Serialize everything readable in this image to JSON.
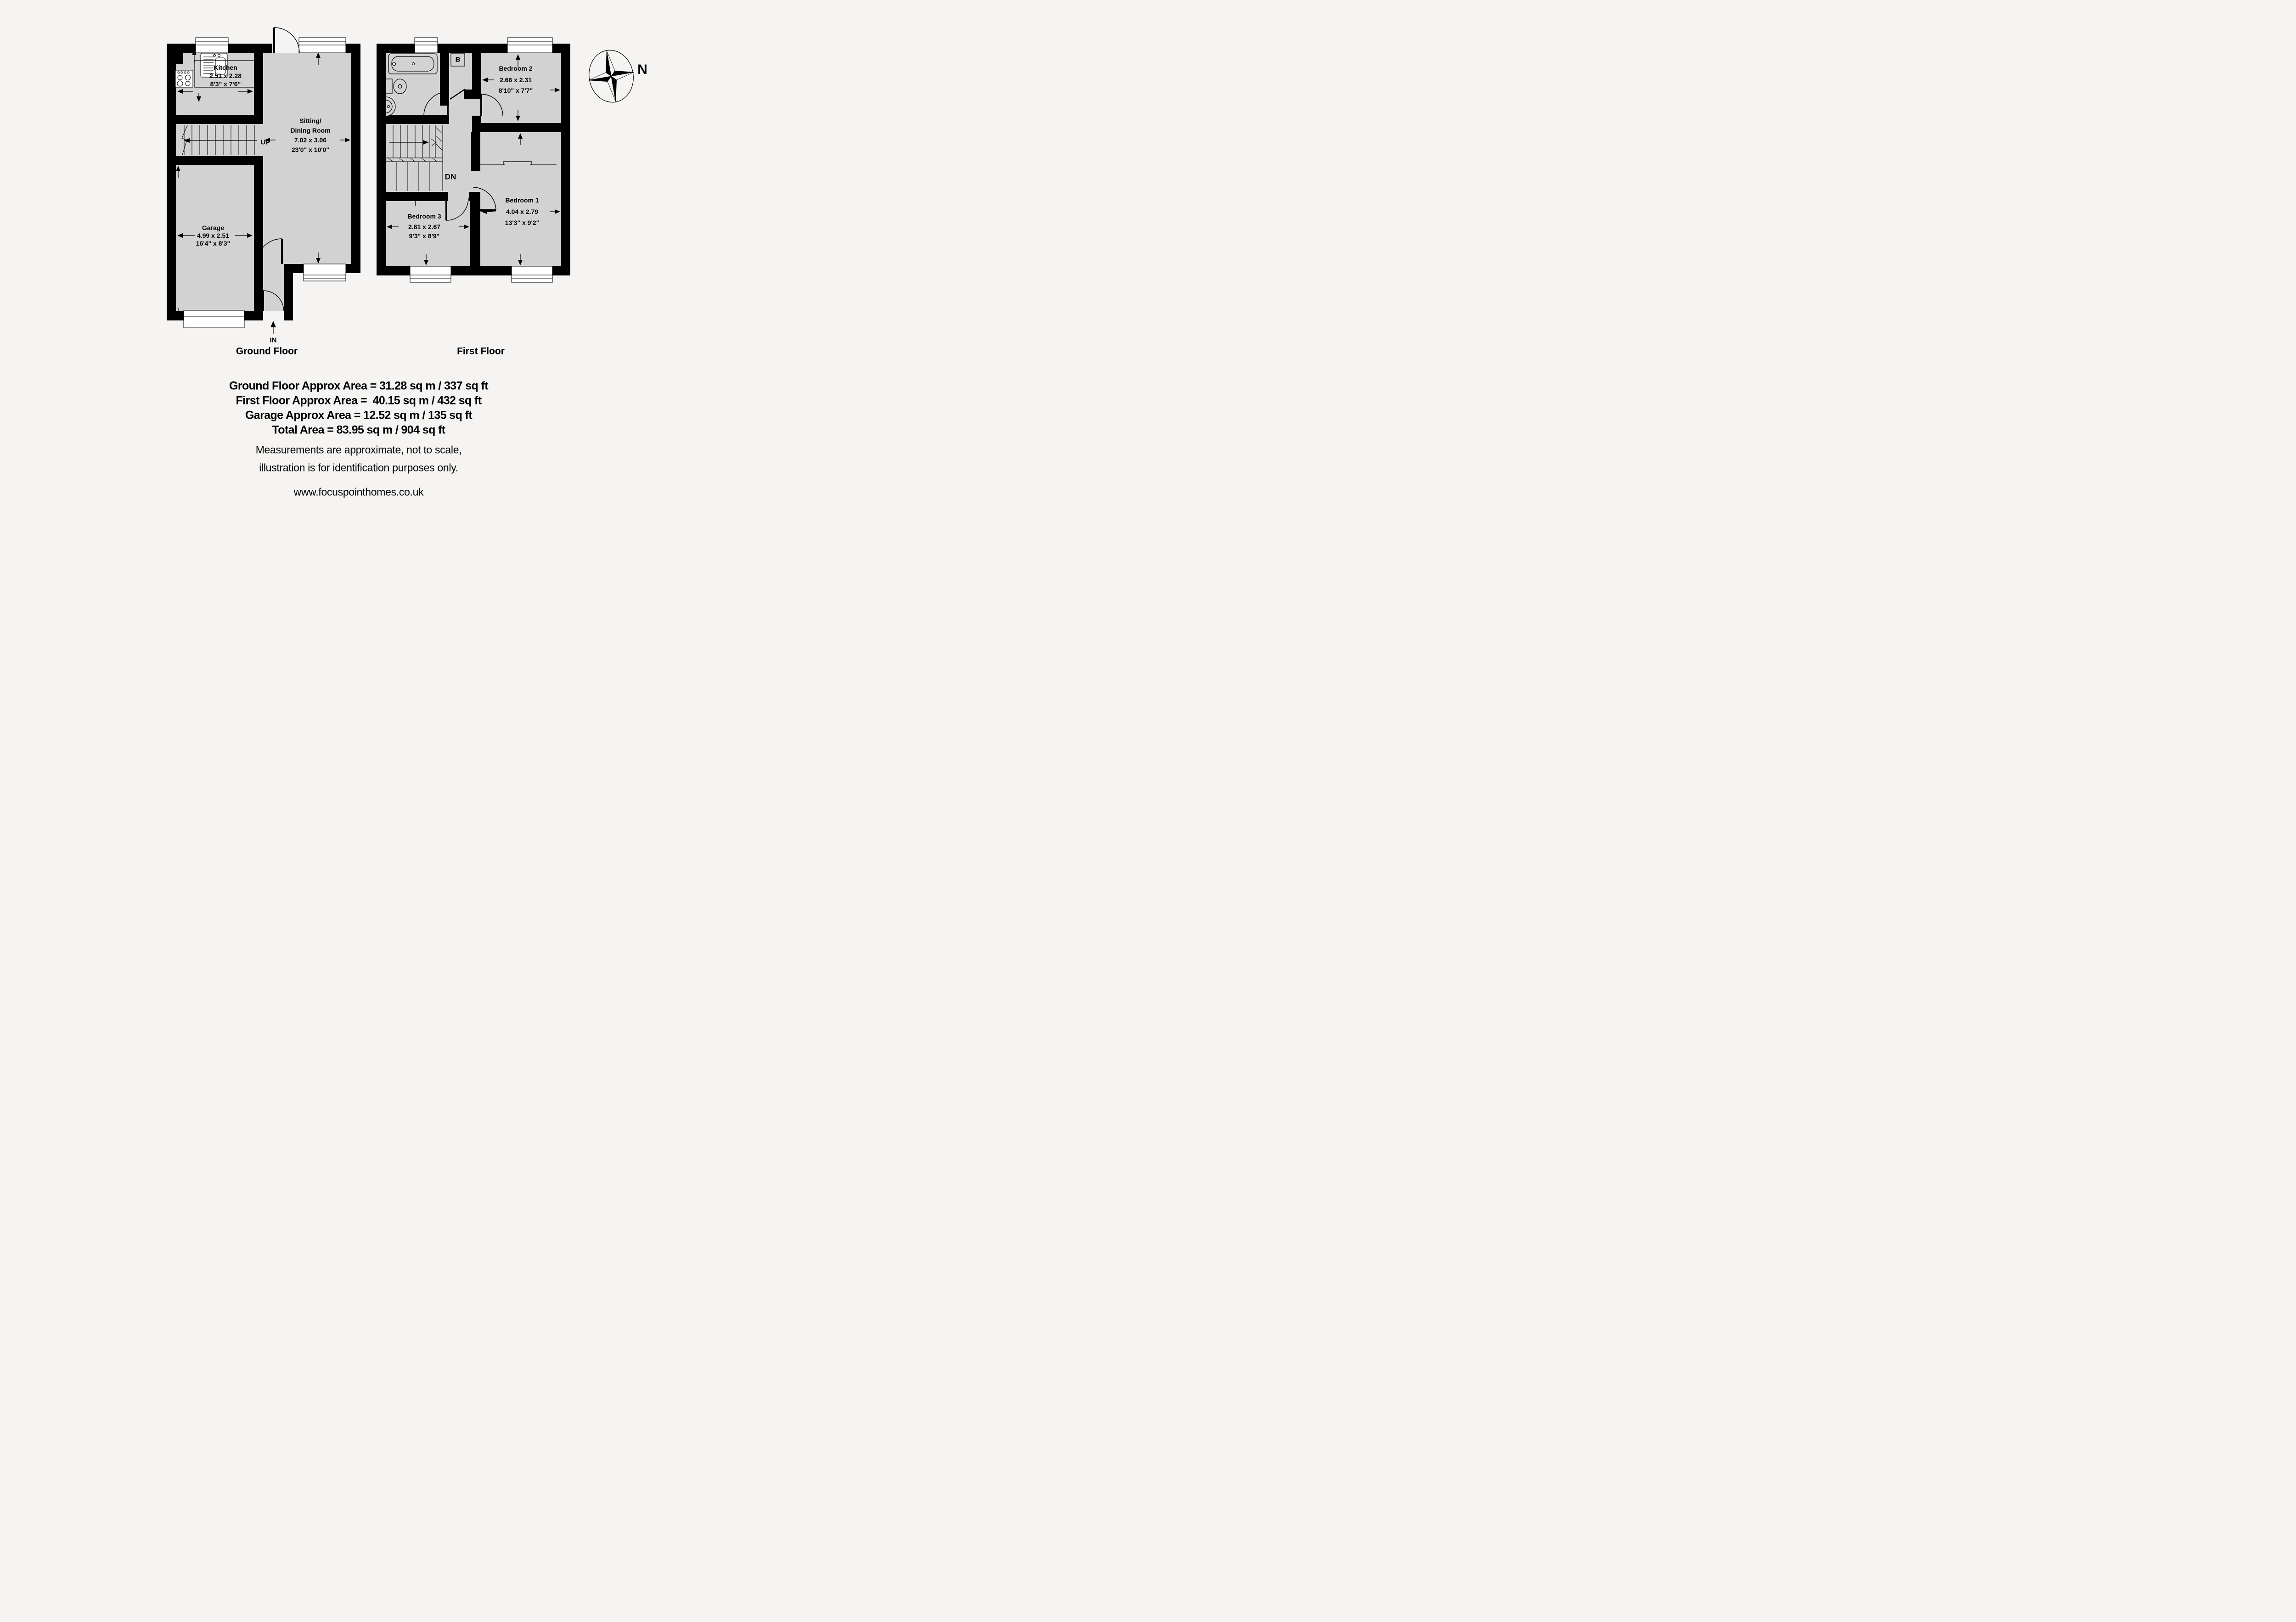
{
  "colors": {
    "background": "#f5f4f2",
    "floor_fill": "#d2d2d2",
    "wall": "#000000",
    "window_fill": "#ffffff",
    "text": "#000000"
  },
  "ground_floor": {
    "label": "Ground Floor",
    "stairs_label": "UP",
    "entrance_label": "IN",
    "rooms": {
      "kitchen": {
        "name": "Kitchen",
        "metric": "2.51 x 2.28",
        "imperial": "8'3\" x 7'6\""
      },
      "sitting_dining": {
        "name_line1": "Sitting/",
        "name_line2": "Dining Room",
        "metric": "7.02 x 3.06",
        "imperial": "23'0\" x 10'0\""
      },
      "garage": {
        "name": "Garage",
        "metric": "4.99 x 2.51",
        "imperial": "16'4\" x 8'3\""
      }
    }
  },
  "first_floor": {
    "label": "First Floor",
    "stairs_label": "DN",
    "boiler_label": "B",
    "rooms": {
      "bedroom1": {
        "name": "Bedroom 1",
        "metric": "4.04 x 2.79",
        "imperial": "13'3\" x 9'2\""
      },
      "bedroom2": {
        "name": "Bedroom 2",
        "metric": "2.68 x 2.31",
        "imperial": "8'10\" x 7'7\""
      },
      "bedroom3": {
        "name": "Bedroom 3",
        "metric": "2.81 x 2.67",
        "imperial": "9'3\" x 8'9\""
      }
    }
  },
  "compass": {
    "north_label": "N"
  },
  "footer": {
    "areas": [
      "Ground Floor Approx Area = 31.28 sq m / 337 sq ft",
      "First Floor Approx Area =  40.15 sq m / 432 sq ft",
      "Garage Approx Area = 12.52 sq m / 135 sq ft",
      "Total Area = 83.95 sq m / 904 sq ft"
    ],
    "disclaimer": [
      "Measurements are approximate, not to scale,",
      "illustration is for identification purposes only."
    ],
    "website": "www.focuspointhomes.co.uk"
  }
}
